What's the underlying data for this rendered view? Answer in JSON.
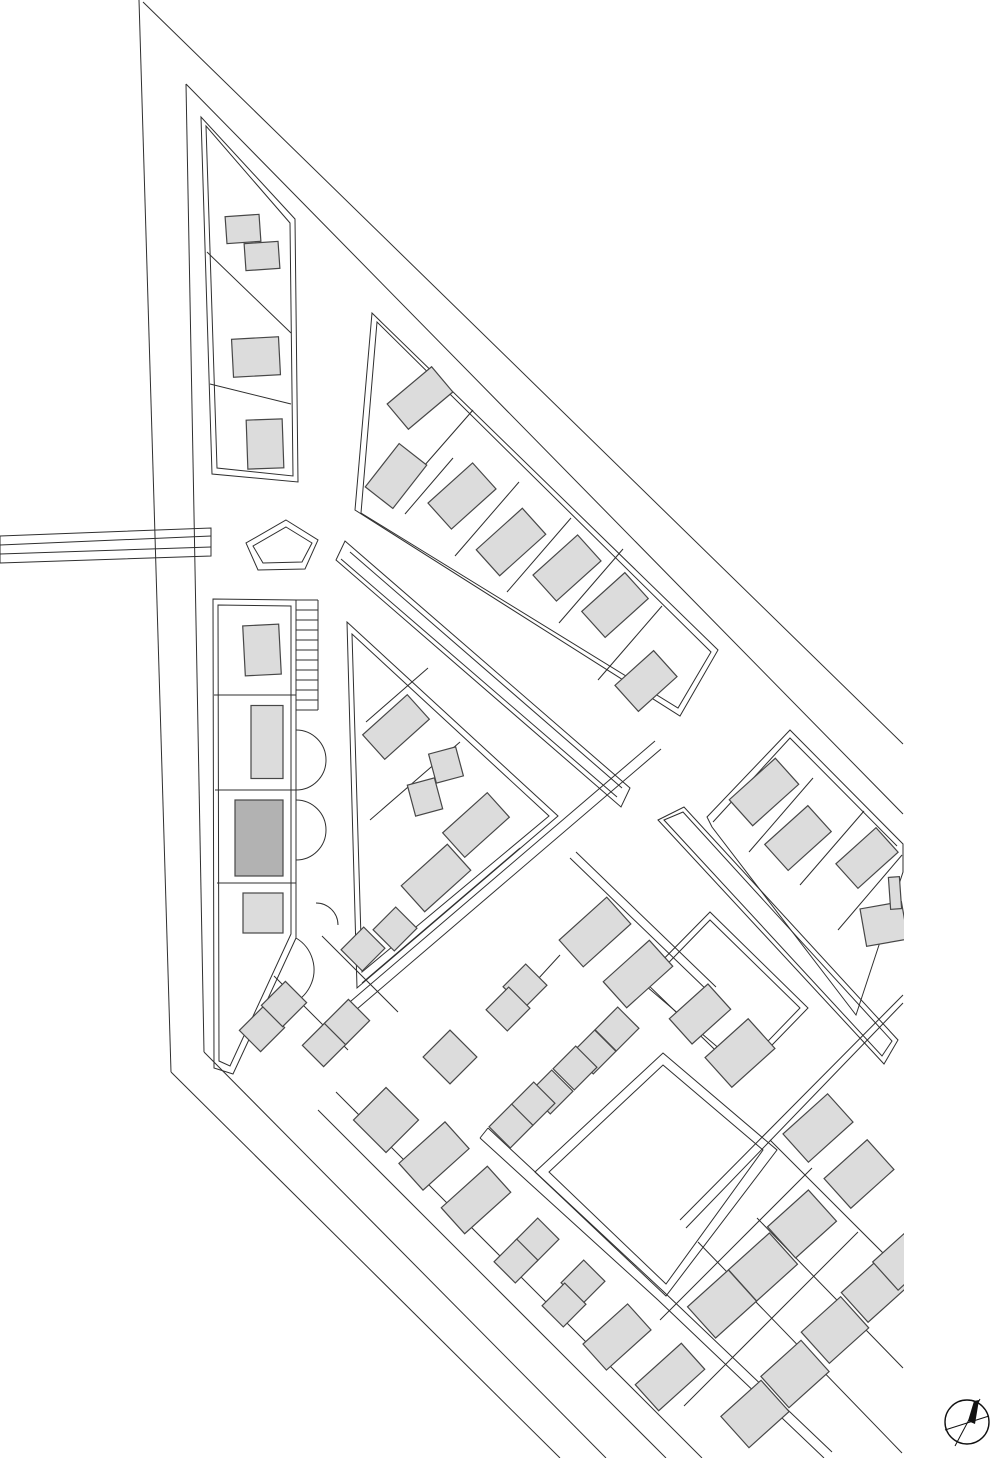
{
  "canvas": {
    "width": 1000,
    "height": 1458,
    "background": "#ffffff",
    "clip_width": 904
  },
  "style": {
    "line_color": "#2f2f2f",
    "line_width": 1,
    "outline_width": 1,
    "building_fill": "#dcdcdc",
    "building_fill_dark": "#b2b2b2",
    "building_stroke": "#474747",
    "building_stroke_width": 1.2,
    "compass_color": "#111111"
  },
  "drawing": {
    "boundary_lines": [
      [
        139,
        0,
        171,
        1072
      ],
      [
        171,
        1072,
        560,
        1458
      ],
      [
        186,
        84,
        204,
        1052
      ],
      [
        204,
        1052,
        606,
        1458
      ],
      [
        143,
        2,
        903,
        744
      ],
      [
        186,
        84,
        903,
        814
      ]
    ],
    "street_lines": [
      [
        0,
        545,
        211,
        536
      ],
      [
        0,
        554,
        211,
        547
      ],
      [
        655,
        741,
        330,
        1019
      ],
      [
        661,
        749,
        336,
        1027
      ],
      [
        903,
        995,
        680,
        1220
      ],
      [
        903,
        1003,
        686,
        1228
      ],
      [
        318,
        1110,
        666,
        1458
      ],
      [
        336,
        1092,
        702,
        1458
      ],
      [
        570,
        858,
        710,
        993
      ],
      [
        576,
        852,
        716,
        987
      ],
      [
        350,
        552,
        622,
        788
      ],
      [
        341,
        559,
        617,
        797
      ],
      [
        488,
        1128,
        480,
        1138
      ]
    ],
    "street_polylines": [
      [
        [
          488,
          1128
        ],
        [
          532,
          1169
        ],
        [
          664,
          1292
        ],
        [
          832,
          1452
        ]
      ],
      [
        [
          480,
          1138
        ],
        [
          526,
          1180
        ],
        [
          658,
          1300
        ],
        [
          824,
          1458
        ]
      ],
      [
        [
          713,
          822
        ],
        [
          790,
          738
        ],
        [
          897,
          846
        ]
      ]
    ],
    "parcel_lines": [
      [
        207,
        252,
        291,
        333
      ],
      [
        210,
        384,
        291,
        404
      ],
      [
        214,
        695,
        296,
        695
      ],
      [
        215,
        790,
        296,
        790
      ],
      [
        217,
        883,
        296,
        883
      ],
      [
        473,
        410,
        417,
        474
      ],
      [
        453,
        458,
        405,
        514
      ],
      [
        519,
        482,
        455,
        556
      ],
      [
        571,
        518,
        507,
        592
      ],
      [
        623,
        549,
        559,
        623
      ],
      [
        662,
        606,
        598,
        680
      ],
      [
        428,
        668,
        366,
        722
      ],
      [
        460,
        742,
        370,
        820
      ],
      [
        520,
        848,
        362,
        983
      ],
      [
        813,
        778,
        749,
        852
      ],
      [
        864,
        811,
        800,
        885
      ],
      [
        902,
        855,
        838,
        930
      ],
      [
        274,
        976,
        348,
        1050
      ],
      [
        322,
        936,
        398,
        1012
      ],
      [
        560,
        955,
        505,
        1015
      ],
      [
        770,
        1140,
        903,
        1273
      ],
      [
        698,
        1242,
        902,
        1453
      ],
      [
        757,
        1218,
        903,
        1368
      ],
      [
        812,
        1168,
        660,
        1320
      ],
      [
        858,
        1232,
        684,
        1406
      ]
    ],
    "outlines": [
      {
        "n": "road-outline",
        "pts": [
          [
            0,
            536
          ],
          [
            211,
            528
          ],
          [
            211,
            556
          ],
          [
            0,
            563
          ]
        ]
      },
      {
        "n": "pentagon-outer",
        "pts": [
          [
            286,
            520
          ],
          [
            318,
            540
          ],
          [
            305,
            569
          ],
          [
            258,
            570
          ],
          [
            246,
            543
          ]
        ]
      },
      {
        "n": "pentagon-inner",
        "pts": [
          [
            286,
            527
          ],
          [
            312,
            543
          ],
          [
            302,
            562
          ],
          [
            263,
            563
          ],
          [
            253,
            546
          ]
        ]
      },
      {
        "n": "parcel-nw-outer",
        "pts": [
          [
            201,
            117
          ],
          [
            295,
            219
          ],
          [
            298,
            482
          ],
          [
            212,
            474
          ]
        ]
      },
      {
        "n": "parcel-nw-inner",
        "pts": [
          [
            206,
            126
          ],
          [
            290,
            223
          ],
          [
            293,
            476
          ],
          [
            217,
            468
          ]
        ]
      },
      {
        "n": "parcel-west-outer",
        "pts": [
          [
            213,
            599
          ],
          [
            296,
            600
          ],
          [
            296,
            938
          ],
          [
            233,
            1074
          ],
          [
            214,
            1068
          ]
        ]
      },
      {
        "n": "parcel-west-inner",
        "pts": [
          [
            218,
            605
          ],
          [
            291,
            606
          ],
          [
            291,
            934
          ],
          [
            230,
            1066
          ],
          [
            219,
            1061
          ]
        ]
      },
      {
        "n": "block-north-outer",
        "pts": [
          [
            372,
            313
          ],
          [
            718,
            650
          ],
          [
            680,
            716
          ],
          [
            355,
            510
          ]
        ]
      },
      {
        "n": "block-north-inner",
        "pts": [
          [
            377,
            322
          ],
          [
            711,
            652
          ],
          [
            678,
            708
          ],
          [
            361,
            513
          ]
        ]
      },
      {
        "n": "street-strip-upper",
        "pts": [
          [
            345,
            541
          ],
          [
            630,
            788
          ],
          [
            621,
            807
          ],
          [
            336,
            560
          ]
        ]
      },
      {
        "n": "street-strip-lower-outer",
        "pts": [
          [
            658,
            820
          ],
          [
            684,
            807
          ],
          [
            898,
            1040
          ],
          [
            884,
            1064
          ]
        ]
      },
      {
        "n": "street-strip-lower-inner",
        "pts": [
          [
            664,
            820
          ],
          [
            683,
            812
          ],
          [
            892,
            1041
          ],
          [
            882,
            1056
          ]
        ]
      },
      {
        "n": "block-center-outer",
        "pts": [
          [
            347,
            622
          ],
          [
            558,
            816
          ],
          [
            357,
            988
          ]
        ]
      },
      {
        "n": "block-center-inner",
        "pts": [
          [
            352,
            634
          ],
          [
            549,
            816
          ],
          [
            362,
            972
          ]
        ]
      },
      {
        "n": "block-east-outer",
        "pts": [
          [
            707,
            817
          ],
          [
            790,
            730
          ],
          [
            903,
            844
          ],
          [
            903,
            872
          ],
          [
            856,
            1015
          ],
          [
            712,
            827
          ]
        ]
      },
      {
        "n": "plaza-outer",
        "pts": [
          [
            663,
            1053
          ],
          [
            777,
            1150
          ],
          [
            666,
            1296
          ],
          [
            535,
            1172
          ]
        ]
      },
      {
        "n": "plaza-inner",
        "pts": [
          [
            663,
            1065
          ],
          [
            763,
            1150
          ],
          [
            666,
            1284
          ],
          [
            549,
            1172
          ]
        ]
      },
      {
        "n": "block-mid-east-outer",
        "pts": [
          [
            643,
            980
          ],
          [
            710,
            912
          ],
          [
            808,
            1008
          ],
          [
            742,
            1076
          ]
        ]
      },
      {
        "n": "block-mid-east-inner",
        "pts": [
          [
            646,
            986
          ],
          [
            710,
            920
          ],
          [
            800,
            1008
          ],
          [
            742,
            1068
          ]
        ]
      }
    ],
    "arcs": [
      "M296,730 A30,30 0 0 1 296,790",
      "M296,800 A30,30 0 0 1 296,860",
      "M296,938 A37,37 0 0 1 263,1004",
      "M316,903 A22,22 0 0 1 338,925"
    ],
    "hatch": {
      "x1": 296,
      "x2": 318,
      "y_start": 600,
      "y_end": 710,
      "step": 10
    },
    "buildings": [
      [
        243,
        229,
        34,
        27,
        -4,
        0
      ],
      [
        262,
        256,
        34,
        27,
        -4,
        0
      ],
      [
        256,
        357,
        47,
        38,
        -3,
        0
      ],
      [
        265,
        444,
        36,
        49,
        -2,
        0
      ],
      [
        262,
        650,
        36,
        50,
        -3,
        0
      ],
      [
        267,
        742,
        32,
        73,
        0,
        0
      ],
      [
        259,
        838,
        48,
        76,
        0,
        1
      ],
      [
        263,
        913,
        40,
        40,
        0,
        0
      ],
      [
        420,
        398,
        58,
        33,
        -40,
        0
      ],
      [
        396,
        476,
        55,
        35,
        -52,
        0
      ],
      [
        462,
        496,
        60,
        35,
        -42,
        0
      ],
      [
        511,
        542,
        62,
        35,
        -42,
        0
      ],
      [
        567,
        568,
        60,
        35,
        -42,
        0
      ],
      [
        615,
        605,
        58,
        35,
        -42,
        0
      ],
      [
        646,
        681,
        52,
        35,
        -42,
        0
      ],
      [
        396,
        727,
        60,
        33,
        -42,
        0
      ],
      [
        446,
        765,
        28,
        30,
        -15,
        0
      ],
      [
        425,
        797,
        28,
        32,
        -15,
        0
      ],
      [
        476,
        825,
        60,
        33,
        -42,
        0
      ],
      [
        436,
        878,
        62,
        35,
        -42,
        0
      ],
      [
        363,
        949,
        32,
        30,
        -45,
        0
      ],
      [
        395,
        929,
        32,
        30,
        -45,
        0
      ],
      [
        325,
        1044,
        34,
        30,
        -45,
        0
      ],
      [
        347,
        1022,
        34,
        30,
        -45,
        0
      ],
      [
        262,
        1029,
        34,
        30,
        -45,
        0
      ],
      [
        284,
        1004,
        34,
        30,
        -45,
        0
      ],
      [
        450,
        1057,
        38,
        38,
        -45,
        0
      ],
      [
        386,
        1120,
        46,
        46,
        -45,
        0
      ],
      [
        434,
        1156,
        62,
        36,
        -42,
        0
      ],
      [
        764,
        792,
        62,
        35,
        -42,
        0
      ],
      [
        798,
        838,
        58,
        35,
        -42,
        0
      ],
      [
        867,
        858,
        54,
        33,
        -42,
        0
      ],
      [
        884,
        924,
        42,
        38,
        -10,
        0
      ],
      [
        895,
        893,
        11,
        32,
        -4,
        0
      ],
      [
        595,
        932,
        64,
        36,
        -42,
        0
      ],
      [
        638,
        974,
        62,
        35,
        -42,
        0
      ],
      [
        525,
        986,
        32,
        30,
        -45,
        0
      ],
      [
        508,
        1009,
        32,
        30,
        -45,
        0
      ],
      [
        617,
        1029,
        32,
        30,
        -45,
        0
      ],
      [
        594,
        1052,
        32,
        30,
        -45,
        0
      ],
      [
        575,
        1068,
        32,
        30,
        -45,
        0
      ],
      [
        551,
        1092,
        32,
        30,
        -45,
        0
      ],
      [
        533,
        1104,
        32,
        30,
        -45,
        0
      ],
      [
        511,
        1126,
        32,
        30,
        -45,
        0
      ],
      [
        700,
        1014,
        52,
        34,
        -42,
        0
      ],
      [
        740,
        1053,
        58,
        40,
        -42,
        0
      ],
      [
        476,
        1200,
        62,
        35,
        -42,
        0
      ],
      [
        537,
        1240,
        32,
        30,
        -45,
        0
      ],
      [
        516,
        1261,
        32,
        30,
        -45,
        0
      ],
      [
        583,
        1282,
        32,
        30,
        -45,
        0
      ],
      [
        564,
        1305,
        32,
        30,
        -45,
        0
      ],
      [
        617,
        1337,
        60,
        35,
        -42,
        0
      ],
      [
        670,
        1377,
        62,
        35,
        -42,
        0
      ],
      [
        818,
        1128,
        60,
        38,
        -42,
        0
      ],
      [
        859,
        1174,
        58,
        40,
        -42,
        0
      ],
      [
        802,
        1224,
        55,
        42,
        -42,
        0
      ],
      [
        763,
        1267,
        55,
        42,
        -42,
        0
      ],
      [
        722,
        1304,
        55,
        42,
        -42,
        0
      ],
      [
        874,
        1290,
        52,
        40,
        -42,
        0
      ],
      [
        835,
        1330,
        53,
        42,
        -42,
        0
      ],
      [
        795,
        1374,
        54,
        42,
        -42,
        0
      ],
      [
        755,
        1414,
        54,
        42,
        -42,
        0
      ],
      [
        901,
        1262,
        42,
        38,
        -42,
        0
      ]
    ],
    "compass": {
      "cx": 967,
      "cy": 1422,
      "r": 22,
      "cross": [
        [
          945,
          1430,
          989,
          1416
        ],
        [
          955,
          1446,
          980,
          1399
        ]
      ],
      "needle": [
        [
          979,
          1400
        ],
        [
          975,
          1424
        ],
        [
          968,
          1421
        ],
        [
          974,
          1401
        ]
      ]
    }
  }
}
